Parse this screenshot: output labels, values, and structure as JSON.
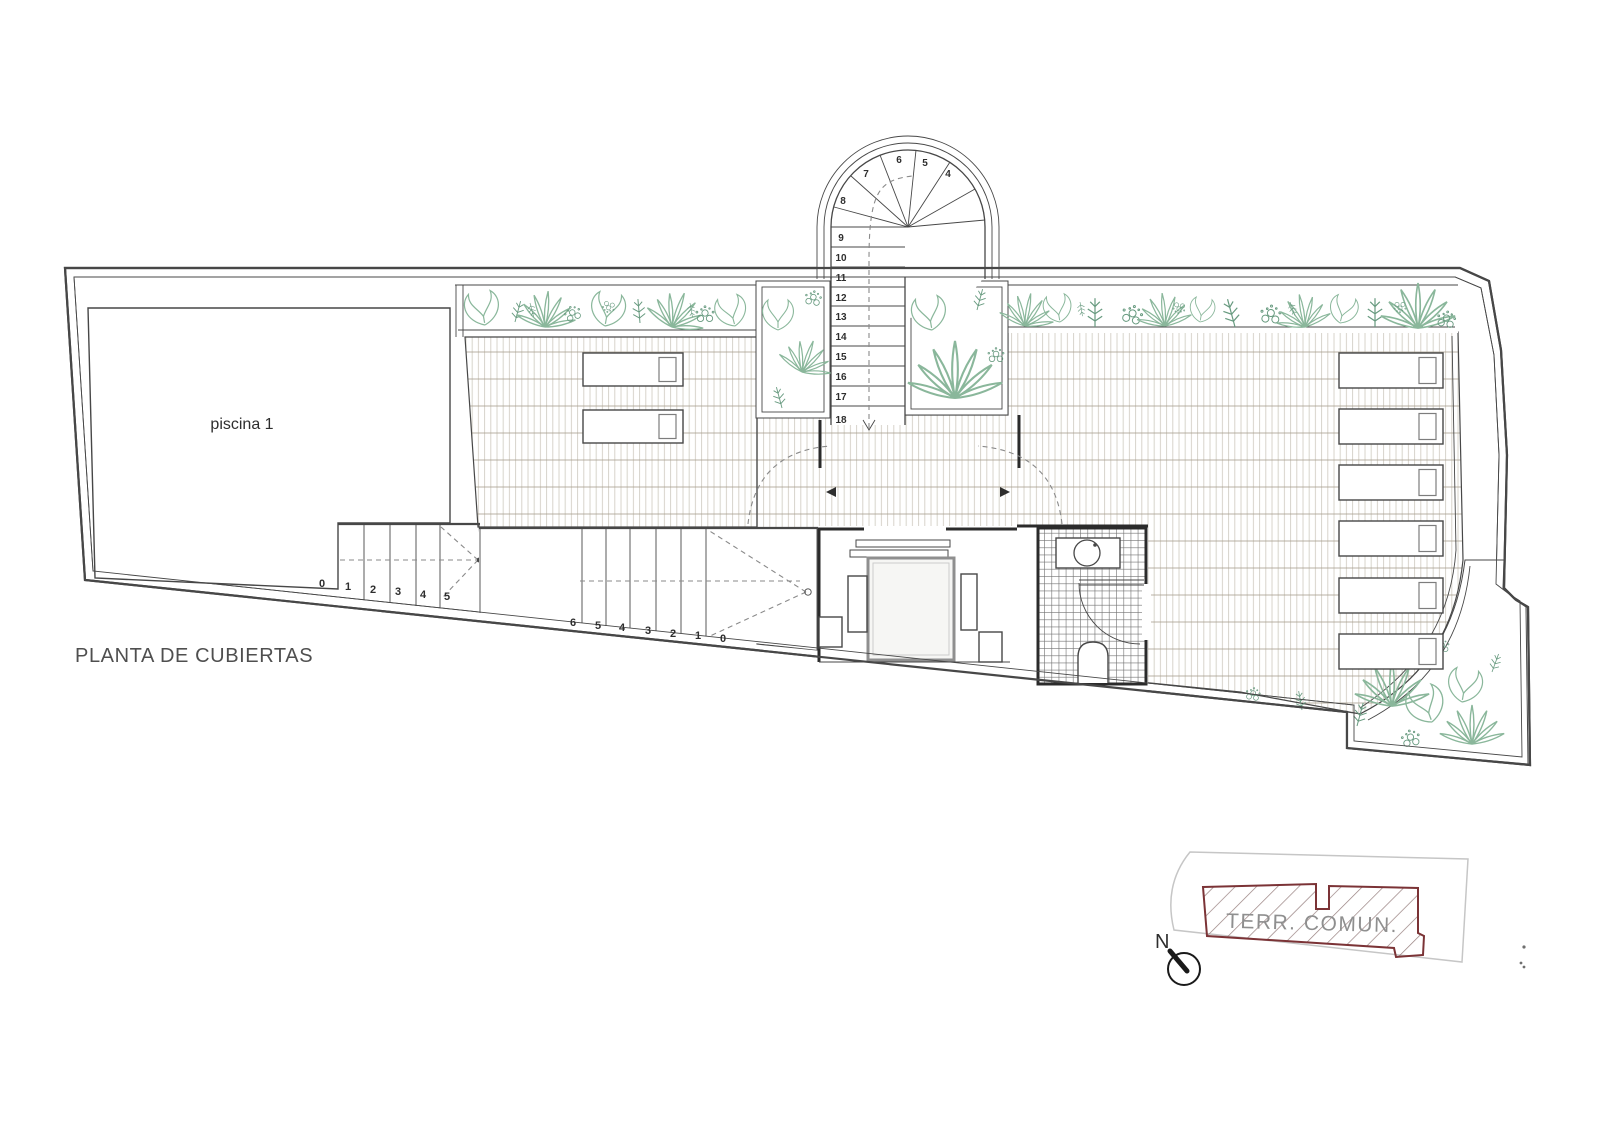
{
  "title": "PLANTA DE CUBIERTAS",
  "pool": {
    "label": "piscina 1"
  },
  "stairs": {
    "pool_steps": [
      "0",
      "1",
      "2",
      "3",
      "4",
      "5"
    ],
    "mid_steps": [
      "6",
      "5",
      "4",
      "3",
      "2",
      "1",
      "0"
    ],
    "spiral_fan": [
      "8",
      "7",
      "6",
      "5",
      "4"
    ],
    "spiral_run": [
      "9",
      "10",
      "11",
      "12",
      "13",
      "14",
      "15",
      "16",
      "17",
      "18"
    ]
  },
  "loungers": {
    "left_count": 2,
    "right_count": 6
  },
  "keyplan": {
    "area_label": "TERR. COMUN.",
    "north_label": "N"
  },
  "colors": {
    "ink": "#474747",
    "ink2": "#2e2e2e",
    "wall": "#2b2b2b",
    "dash": "#8a8a8a",
    "green": "#8ab79b",
    "green2": "#679a7f",
    "deck_v": "#d7d3cb",
    "deck_h": "#a69e8d",
    "tile": "#6f6f6f",
    "text": "#4f4f4f",
    "kp_border": "#7b3336",
    "kp_hatch": "#97807f",
    "kp_site": "#c6c6c6",
    "kp_text": "#8f8f8f"
  }
}
